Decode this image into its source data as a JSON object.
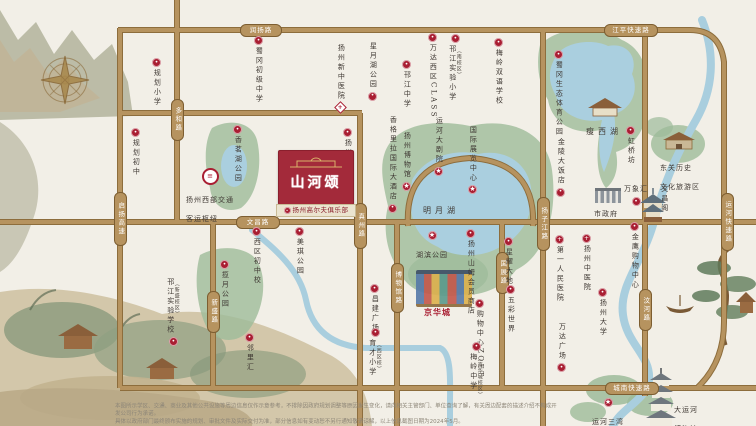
{
  "project": {
    "name": "山河颂",
    "banner": "扬州高尔夫俱乐部",
    "accent_red": "#a91e32",
    "road_gold": "#b6935f",
    "paper": "#f2efe7"
  },
  "road_badges": [
    {
      "id": "runyang-rd",
      "label": "润扬路",
      "x": 240,
      "y": 24,
      "orient": "h",
      "len": 34
    },
    {
      "id": "jiangping-expwy",
      "label": "江平快速路",
      "x": 604,
      "y": 24,
      "orient": "h",
      "len": 46
    },
    {
      "id": "wenchang-rd",
      "label": "文昌路",
      "x": 236,
      "y": 216,
      "orient": "h",
      "len": 36
    },
    {
      "id": "chengnan-expwy",
      "label": "城南快速路",
      "x": 605,
      "y": 382,
      "orient": "h",
      "len": 46
    },
    {
      "id": "qiyang-hwy",
      "label": "启扬高速",
      "x": 114,
      "y": 192,
      "orient": "v",
      "len": 46
    },
    {
      "id": "duohe-rd",
      "label": "多和路",
      "x": 171,
      "y": 99,
      "orient": "v",
      "len": 34
    },
    {
      "id": "xinsheng-rd",
      "label": "新盛路",
      "x": 207,
      "y": 291,
      "orient": "v",
      "len": 34
    },
    {
      "id": "zhenzhou-rd",
      "label": "真州路",
      "x": 354,
      "y": 203,
      "orient": "v",
      "len": 38
    },
    {
      "id": "bowuguan-rd",
      "label": "博物馆路",
      "x": 391,
      "y": 263,
      "orient": "v",
      "len": 42
    },
    {
      "id": "guozhan-rd",
      "label": "国展路",
      "x": 496,
      "y": 252,
      "orient": "v",
      "len": 34
    },
    {
      "id": "yangzijiang-rd",
      "label": "扬子江路",
      "x": 537,
      "y": 197,
      "orient": "v",
      "len": 46
    },
    {
      "id": "wenhe-rd",
      "label": "汶河路",
      "x": 639,
      "y": 289,
      "orient": "v",
      "len": 34
    },
    {
      "id": "yunhe-expwy",
      "label": "运河快速路",
      "x": 721,
      "y": 193,
      "orient": "v",
      "len": 50
    }
  ],
  "pois": [
    {
      "id": "guihua-primary",
      "label": "规划小学",
      "x": 152,
      "y": 58,
      "dir": "v",
      "icon": "dot"
    },
    {
      "id": "guihua-middle",
      "label": "规划初中",
      "x": 131,
      "y": 128,
      "dir": "v",
      "icon": "dot"
    },
    {
      "id": "shugang-middle",
      "label": "蜀冈初级中学",
      "x": 254,
      "y": 36,
      "dir": "v",
      "icon": "dot"
    },
    {
      "id": "xin-tcm-hospital",
      "label": "扬州新中医院",
      "x": 336,
      "y": 44,
      "dir": "v",
      "icon": "diamond",
      "icon_pos": "bottom"
    },
    {
      "id": "xingyuehu-park",
      "label": "星月湖公园",
      "x": 368,
      "y": 42,
      "dir": "v",
      "icon": "dot",
      "icon_pos": "bottom"
    },
    {
      "id": "hanjiang-middle",
      "label": "邗江中学",
      "x": 402,
      "y": 60,
      "dir": "v",
      "icon": "dot"
    },
    {
      "id": "wanda-west-class",
      "label": "万达西区CLASS",
      "x": 428,
      "y": 33,
      "dir": "v",
      "icon": "dot"
    },
    {
      "id": "hanjiang-exp-primary",
      "label": "邗江实验小学",
      "x": 448,
      "y": 34,
      "dir": "v",
      "icon": "dot",
      "bracket": "（南校区）"
    },
    {
      "id": "meiling-bilingual",
      "label": "梅岭双语学校",
      "x": 494,
      "y": 38,
      "dir": "v",
      "icon": "dot"
    },
    {
      "id": "shugang-sports-park",
      "label": "蜀冈生态体育公园",
      "x": 554,
      "y": 50,
      "dir": "v",
      "icon": "dot"
    },
    {
      "id": "shouxihu",
      "label": "瘦西湖",
      "x": 586,
      "y": 119,
      "dir": "h",
      "icon": "none",
      "big": true
    },
    {
      "id": "hongqiaofang",
      "label": "虹桥坊",
      "x": 626,
      "y": 126,
      "dir": "v",
      "icon": "dot"
    },
    {
      "id": "dongguan-district",
      "label": "东关历史",
      "label2": "文化旅游区",
      "x": 660,
      "y": 155,
      "dir": "h2",
      "icon": "none"
    },
    {
      "id": "shizhengfu",
      "label": "市政府",
      "x": 594,
      "y": 201,
      "dir": "h",
      "icon": "none"
    },
    {
      "id": "wanxianghui",
      "label": "万象汇",
      "x": 624,
      "y": 176,
      "dir": "h",
      "icon": "dot",
      "icon_pos": "bottom"
    },
    {
      "id": "wenchangge",
      "label": "文昌阁",
      "x": 660,
      "y": 185,
      "dir": "v",
      "icon": "none"
    },
    {
      "id": "jinling-hotel",
      "label": "金陵大饭店",
      "x": 556,
      "y": 138,
      "dir": "v",
      "icon": "dot",
      "icon_pos": "bottom"
    },
    {
      "id": "jinying-mall",
      "label": "金鹰购物中心",
      "x": 630,
      "y": 222,
      "dir": "v",
      "icon": "dot"
    },
    {
      "id": "yangzhou-tcm-hospital",
      "label": "扬州中医院",
      "x": 582,
      "y": 234,
      "dir": "v",
      "icon": "plus"
    },
    {
      "id": "first-people-hospital",
      "label": "第一人民医院",
      "x": 555,
      "y": 235,
      "dir": "v",
      "icon": "plus"
    },
    {
      "id": "yangzhou-university",
      "label": "扬州大学",
      "x": 598,
      "y": 288,
      "dir": "v",
      "icon": "dot"
    },
    {
      "id": "wanda-plaza",
      "label": "万达广场",
      "x": 557,
      "y": 323,
      "dir": "v",
      "icon": "dot",
      "icon_pos": "bottom"
    },
    {
      "id": "sanwan-scenic",
      "label": "运河三湾",
      "label2": "风景区",
      "x": 592,
      "y": 398,
      "dir": "h2",
      "icon": "star"
    },
    {
      "id": "grand-canal-museum",
      "label": "大运河",
      "label2": "博物馆",
      "x": 674,
      "y": 397,
      "dir": "h2",
      "icon": "none"
    },
    {
      "id": "west-transport-hub",
      "label": "扬州西部交通",
      "label2": "客运枢纽",
      "x": 186,
      "y": 168,
      "dir": "h2",
      "icon": "transit"
    },
    {
      "id": "xiangminghu-park",
      "label": "香茗湖公园",
      "x": 233,
      "y": 125,
      "dir": "v",
      "icon": "dot"
    },
    {
      "id": "lanyue-park",
      "label": "揽月公园",
      "x": 220,
      "y": 260,
      "dir": "v",
      "icon": "dot"
    },
    {
      "id": "west-district-middle",
      "label": "西区初中校",
      "x": 252,
      "y": 227,
      "dir": "v",
      "icon": "dot"
    },
    {
      "id": "meiqi-park",
      "label": "美琪公园",
      "x": 295,
      "y": 227,
      "dir": "v",
      "icon": "dot"
    },
    {
      "id": "hanjiang-exp-school",
      "label": "邗江实验学校",
      "x": 166,
      "y": 278,
      "dir": "v",
      "icon": "dot",
      "icon_pos": "bottom",
      "bracket": "（新盛校区）"
    },
    {
      "id": "linlihui",
      "label": "邻里汇",
      "x": 245,
      "y": 333,
      "dir": "v",
      "icon": "dot"
    },
    {
      "id": "changjian-plaza",
      "label": "昌建广场",
      "x": 370,
      "y": 284,
      "dir": "v",
      "icon": "dot"
    },
    {
      "id": "yucai-primary",
      "label": "育才小学",
      "x": 368,
      "y": 328,
      "dir": "v",
      "icon": "dot",
      "bracket": "（西区校）"
    },
    {
      "id": "jinghuacheng",
      "label": "京华城",
      "x": 424,
      "y": 300,
      "dir": "h",
      "icon": "none",
      "red": true
    },
    {
      "id": "hubin-park",
      "label": "湖滨公园",
      "x": 416,
      "y": 231,
      "dir": "h",
      "icon": "star"
    },
    {
      "id": "sams-club",
      "label": "扬州山姆会员商店",
      "x": 466,
      "y": 229,
      "dir": "v",
      "icon": "dot"
    },
    {
      "id": "xingyao-dadi",
      "label": "星耀大地",
      "x": 504,
      "y": 237,
      "dir": "v",
      "icon": "dot"
    },
    {
      "id": "wucai-world",
      "label": "五彩世界",
      "x": 506,
      "y": 285,
      "dir": "v",
      "icon": "dot"
    },
    {
      "id": "shopping-center-zoet",
      "label": "购物中心ZOET",
      "x": 475,
      "y": 299,
      "dir": "v",
      "icon": "dot"
    },
    {
      "id": "meiling-middle",
      "label": "梅岭中学",
      "x": 469,
      "y": 342,
      "dir": "v",
      "icon": "dot",
      "bracket": "（京华城校区）"
    },
    {
      "id": "yangzhou-sports-park",
      "label": "扬州体育公园",
      "x": 343,
      "y": 128,
      "dir": "v",
      "icon": "dot"
    },
    {
      "id": "shangri-la-hotel",
      "label": "香格里拉国际大酒店",
      "x": 388,
      "y": 116,
      "dir": "v",
      "icon": "dot",
      "icon_pos": "bottom"
    },
    {
      "id": "yangzhou-museum",
      "label": "扬州博物馆",
      "x": 402,
      "y": 132,
      "dir": "v",
      "icon": "star",
      "icon_pos": "bottom"
    },
    {
      "id": "canal-theatre",
      "label": "运河大剧院",
      "x": 434,
      "y": 117,
      "dir": "v",
      "icon": "star",
      "icon_pos": "bottom"
    },
    {
      "id": "intl-expo-center",
      "label": "国际展览中心",
      "x": 468,
      "y": 126,
      "dir": "v",
      "icon": "star",
      "icon_pos": "bottom"
    },
    {
      "id": "mingyuehu",
      "label": "明月湖",
      "x": 423,
      "y": 198,
      "dir": "h",
      "icon": "none",
      "big": true
    }
  ],
  "icon_glyphs": {
    "dot": "•",
    "star": "★",
    "plus": "+",
    "transit": "≡",
    "diamond": "+"
  },
  "disclaimer": {
    "line1": "本图所示学区、交通、商业及其他公共设施等周边信息仅作示意参考，不排除因政府规划调整等原因发生变化，请向相关主管部门、单位查询了解，有关周边配套的描述介绍不构成开发公司行为承诺。",
    "line2": "具体以政府部门最终颁布实施的规划、审批文件及实际交付为准，部分信息如有变动恕不另行通知敬请谅解，以上信息截图日期为2024年5月。"
  }
}
